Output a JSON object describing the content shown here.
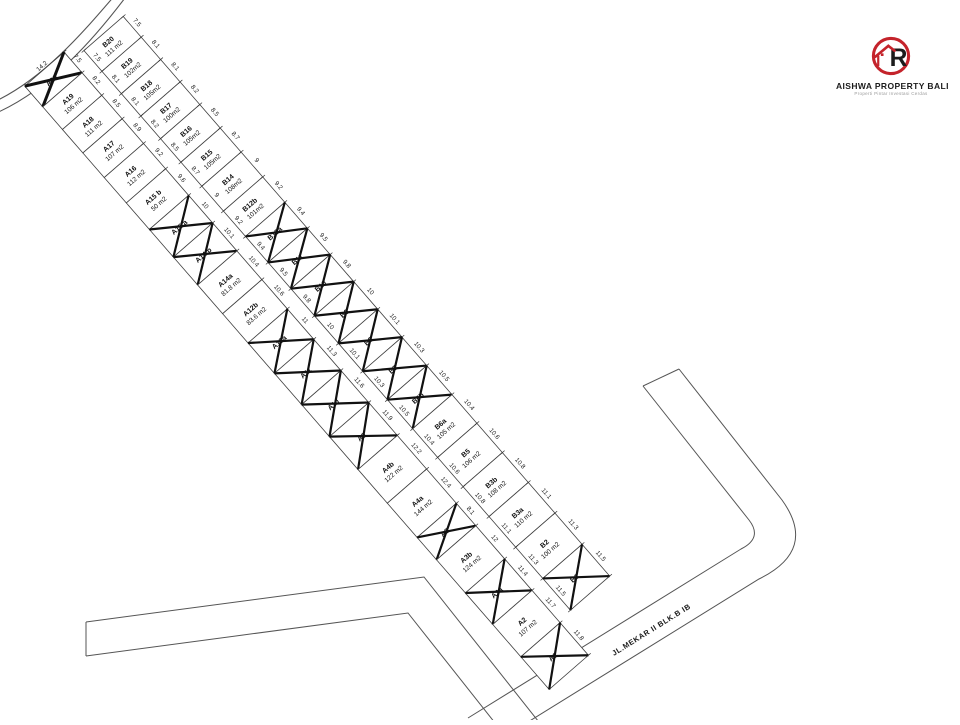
{
  "company": {
    "name": "AISHWA PROPERTY BALI",
    "tagline": "Properti Pintar Investasi Cerdas"
  },
  "road_label": "JL.MEKAR II BLK.B IB",
  "colors": {
    "brand_red": "#c4232b",
    "ink": "#1a1a1a",
    "line": "#555555"
  },
  "rows": [
    {
      "id": "A",
      "plots": [
        {
          "name": "A20",
          "area": "",
          "w": "7.5",
          "sold": true,
          "side": "14.2"
        },
        {
          "name": "A19",
          "area": "106 m2",
          "w": "8.2",
          "sold": false
        },
        {
          "name": "A18",
          "area": "111 m2",
          "w": "8.5",
          "sold": false
        },
        {
          "name": "A17",
          "area": "107 m2",
          "w": "8.9",
          "sold": false
        },
        {
          "name": "A16",
          "area": "112 m2",
          "w": "9.2",
          "sold": false
        },
        {
          "name": "A15 b",
          "area": "50 m2",
          "w": "9.6",
          "sold": false
        },
        {
          "name": "A15 a",
          "area": "",
          "w": "10",
          "sold": true
        },
        {
          "name": "A14 b",
          "area": "",
          "w": "10.1",
          "sold": true
        },
        {
          "name": "A14a",
          "area": "81.8 m2",
          "w": "10.4",
          "sold": false
        },
        {
          "name": "A12b",
          "area": "83.6 m2",
          "w": "10.6",
          "sold": false
        },
        {
          "name": "A12a",
          "area": "",
          "w": "11",
          "sold": true
        },
        {
          "name": "A11",
          "area": "",
          "w": "11.3",
          "sold": true
        },
        {
          "name": "A10",
          "area": "",
          "w": "11.6",
          "sold": true
        },
        {
          "name": "A9",
          "area": "",
          "w": "11.9",
          "sold": true
        },
        {
          "name": "A4b",
          "area": "122 m2",
          "w": "12.2",
          "sold": false
        },
        {
          "name": "A4a",
          "area": "144 m2",
          "w": "12.4",
          "sold": false
        },
        {
          "name": "A5",
          "area": "",
          "w": "8.1",
          "sold": true
        },
        {
          "name": "A3b",
          "area": "124 m2",
          "w": "12",
          "sold": false
        },
        {
          "name": "A3a",
          "area": "",
          "w": "11.4",
          "sold": true
        },
        {
          "name": "A2",
          "area": "107 m2",
          "w": "11.7",
          "sold": false
        },
        {
          "name": "A1",
          "area": "",
          "w": "11.8",
          "sold": true
        }
      ]
    },
    {
      "id": "B",
      "plots": [
        {
          "name": "B20",
          "area": "111 m2",
          "w": "7.5",
          "sold": false,
          "side": "14.2"
        },
        {
          "name": "B19",
          "area": "102m2",
          "w": "8.1",
          "sold": false
        },
        {
          "name": "B18",
          "area": "105m2",
          "w": "8.1",
          "sold": false
        },
        {
          "name": "B17",
          "area": "100m2",
          "w": "8.2",
          "sold": false
        },
        {
          "name": "B16",
          "area": "105m2",
          "w": "8.5",
          "sold": false
        },
        {
          "name": "B15",
          "area": "105m2",
          "w": "8.7",
          "sold": false
        },
        {
          "name": "B14",
          "area": "108m2",
          "w": "9",
          "sold": false
        },
        {
          "name": "B12b",
          "area": "101m2",
          "w": "9.2",
          "sold": false
        },
        {
          "name": "B12a",
          "area": "",
          "w": "9.4",
          "sold": true
        },
        {
          "name": "B11",
          "area": "",
          "w": "9.5",
          "sold": true
        },
        {
          "name": "B10",
          "area": "",
          "w": "9.8",
          "sold": true
        },
        {
          "name": "B9",
          "area": "",
          "w": "10",
          "sold": true
        },
        {
          "name": "B8",
          "area": "",
          "w": "10.1",
          "sold": true
        },
        {
          "name": "B7",
          "area": "",
          "w": "10.3",
          "sold": true
        },
        {
          "name": "B6b",
          "area": "",
          "w": "10.5",
          "sold": true
        },
        {
          "name": "B6a",
          "area": "105 m2",
          "w": "10.4",
          "sold": false
        },
        {
          "name": "B5",
          "area": "106 m2",
          "w": "10.6",
          "sold": false
        },
        {
          "name": "B3b",
          "area": "108 m2",
          "w": "10.8",
          "sold": false
        },
        {
          "name": "B3a",
          "area": "110 m2",
          "w": "11.1",
          "sold": false
        },
        {
          "name": "B2",
          "area": "100 m2",
          "w": "11.3",
          "sold": false
        },
        {
          "name": "B1",
          "area": "",
          "w": "11.5",
          "sold": true
        }
      ]
    }
  ]
}
